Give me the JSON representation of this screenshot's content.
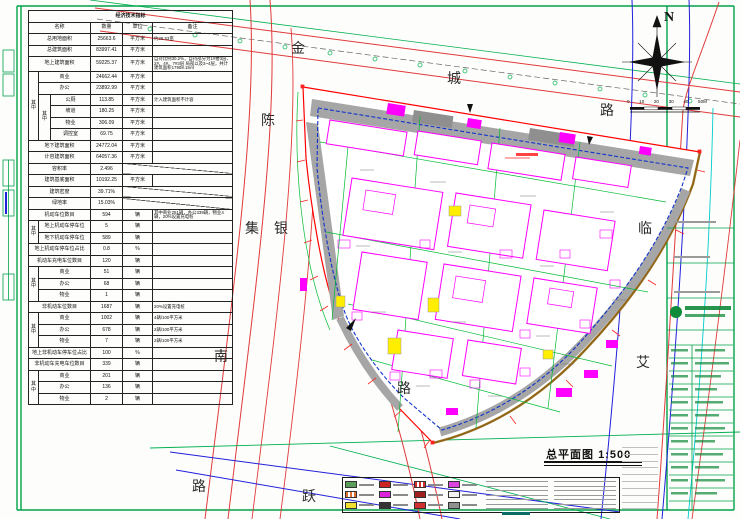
{
  "sheet": {
    "caption": {
      "title": "总平面图",
      "scale": "1:500"
    },
    "north_label": "N",
    "scalebar_ticks": [
      "0",
      "10",
      "20",
      "30",
      "40",
      "50M"
    ],
    "road_labels": {
      "jin": "金",
      "cheng": "城",
      "lu_top": "路",
      "chen": "陈",
      "ji": "集",
      "yin": "银",
      "lin": "临",
      "ai": "艾",
      "nan": "南",
      "lu_sw": "路",
      "yue": "跃",
      "lu_se": "路"
    }
  },
  "table": {
    "title": "经济技术指标",
    "headers": {
      "name": "名称",
      "qty": "数量",
      "unit": "单位",
      "remark": "备注"
    },
    "qizhong": "其中",
    "rows": [
      {
        "name": "总用地面积",
        "qty": "25663.6",
        "unit": "平方米",
        "remark": "约38.53亩"
      },
      {
        "name": "总建筑面积",
        "qty": "83997.41",
        "unit": "平方米"
      },
      {
        "name": "地上建筑面积",
        "qty": "59225.37",
        "unit": "平方米",
        "remark": "自持比例30.2%，自持部分为1#楼3层、2#、4#、7#3层 局部以及3~4层，共计建筑面积17908.19㎡"
      },
      {
        "name": "商业",
        "qty": "24662.44",
        "unit": "平方米"
      },
      {
        "name": "办公",
        "qty": "23892.99",
        "unit": "平方米"
      },
      {
        "name": "公厕",
        "qty": "113.85",
        "unit": "平方米",
        "remark": "计入建筑面积不计容"
      },
      {
        "name": "坡道",
        "qty": "180.25",
        "unit": "平方米"
      },
      {
        "name": "物业",
        "qty": "306.09",
        "unit": "平方米"
      },
      {
        "name": "调控室",
        "qty": "69.75",
        "unit": "平方米"
      },
      {
        "name": "地下建筑面积",
        "qty": "24772.04",
        "unit": "平方米"
      },
      {
        "name": "计容建筑面积",
        "qty": "64057.36",
        "unit": "平方米"
      },
      {
        "name": "容积率",
        "qty": "2.496"
      },
      {
        "name": "建筑基底面积",
        "qty": "10192.25",
        "unit": "平方米"
      },
      {
        "name": "建筑密度",
        "qty": "39.71%"
      },
      {
        "name": "绿地率",
        "qty": "15.03%"
      },
      {
        "name": "机动车位数目",
        "qty": "594",
        "unit": "辆",
        "remark": "其中商业251辆，办公339辆，物业4辆，20%设置充电桩"
      },
      {
        "name": "地上机动车停车位",
        "qty": "5",
        "unit": "辆"
      },
      {
        "name": "地下机动车停车位",
        "qty": "589",
        "unit": "辆"
      },
      {
        "name": "地上机动车停车位占比",
        "qty": "0.8",
        "unit": "%"
      },
      {
        "name": "机动车充电车位数目",
        "qty": "120",
        "unit": "辆"
      },
      {
        "name": "商业",
        "qty": "51",
        "unit": "辆"
      },
      {
        "name": "办公",
        "qty": "68",
        "unit": "辆"
      },
      {
        "name": "物业",
        "qty": "1",
        "unit": "辆"
      },
      {
        "name": "非机动车位数目",
        "qty": "1687",
        "unit": "辆",
        "remark": "20%设置充电桩"
      },
      {
        "name": "商业",
        "qty": "1002",
        "unit": "辆",
        "remark": "4辆/100平方米"
      },
      {
        "name": "办公",
        "qty": "678",
        "unit": "辆",
        "remark": "2辆/100平方米"
      },
      {
        "name": "物业",
        "qty": "7",
        "unit": "辆",
        "remark": "2辆/100平方米"
      },
      {
        "name": "地上非机动车停车位占比",
        "qty": "100",
        "unit": "%"
      },
      {
        "name": "非机动车充电车位数目",
        "qty": "339",
        "unit": "辆"
      },
      {
        "name": "商业",
        "qty": "201",
        "unit": "辆"
      },
      {
        "name": "办公",
        "qty": "136",
        "unit": "辆"
      },
      {
        "name": "物业",
        "qty": "2",
        "unit": "辆"
      }
    ]
  },
  "legend": {
    "swatch_colors": [
      "#5a9e5a",
      "#cc2222",
      "#d03030",
      "#dd44dd",
      "#e07030",
      "#dd22dd",
      "#a02020",
      "#f2f2f2",
      "#f0e030",
      "#333333",
      "#d03030",
      "#909090"
    ]
  },
  "colors": {
    "frame_green": "#00a24a",
    "parcel_boundary_red": "#ff0000",
    "parcel_edge_brown": "#8a6a14",
    "building_magenta": "#ff00ff",
    "road_red": "#e03a3a",
    "road_blue": "#2020dd",
    "road_green": "#00b050",
    "road_cyan": "#00cccc",
    "inner_road_gray": "#a6a6a6",
    "logo_green": "#0f8a3a",
    "highlight_yellow": "#ffee00"
  }
}
